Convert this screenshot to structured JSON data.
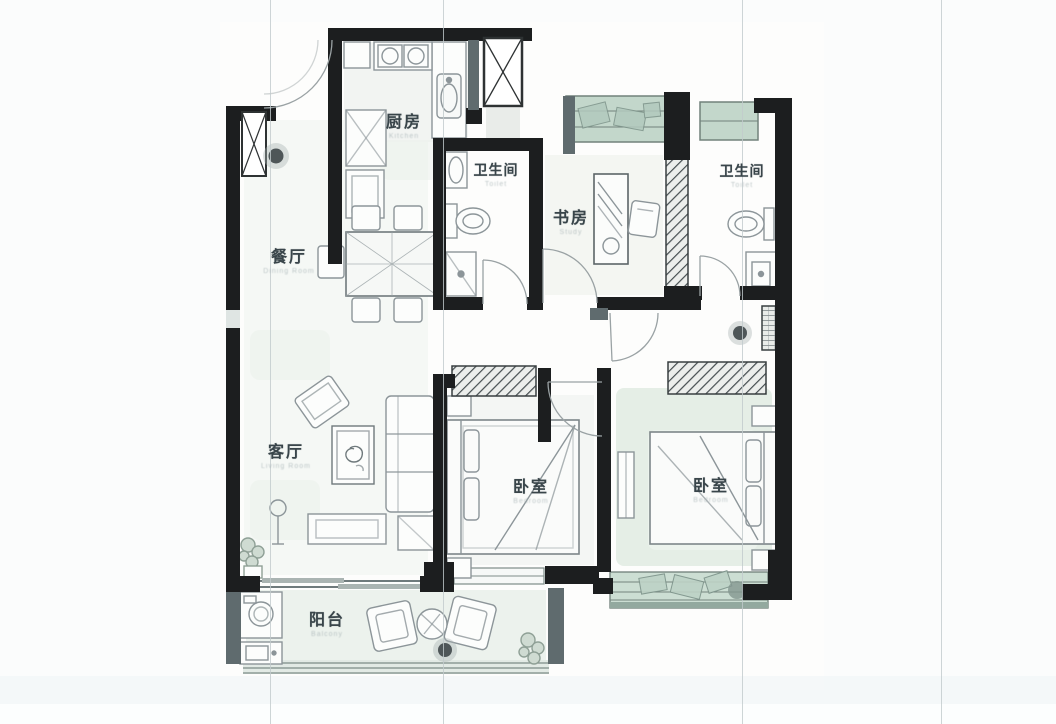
{
  "rooms": {
    "kitchen": {
      "label": "厨房",
      "sublabel": "Kitchen"
    },
    "bathroom_left": {
      "label": "卫生间",
      "sublabel": "Toilet"
    },
    "study": {
      "label": "书房",
      "sublabel": "Study"
    },
    "bathroom_right": {
      "label": "卫生间",
      "sublabel": "Toilet"
    },
    "dining": {
      "label": "餐厅",
      "sublabel": "Dining Room"
    },
    "living": {
      "label": "客厅",
      "sublabel": "Living Room"
    },
    "bedroom_left": {
      "label": "卧室",
      "sublabel": "Bedroom"
    },
    "bedroom_right": {
      "label": "卧室",
      "sublabel": "Bedroom"
    },
    "balcony": {
      "label": "阳台",
      "sublabel": "Balcony"
    }
  },
  "icons": {
    "pendant_light_icon": "filled-circle-with-halo",
    "shaft_icon": "box-with-x-cross",
    "wardrobe_icon": "hatched-box",
    "door_icon": "quarter-arc"
  },
  "colors": {
    "wall": "#1c1e1f",
    "window_glass": "#c3d7cb",
    "window_frame": "#71827b",
    "secondary_wall_gray": "#5f6b6e",
    "sketch_line": "#8c9599",
    "label_text": "#39454a",
    "sublabel_text": "#a9b5b7"
  }
}
